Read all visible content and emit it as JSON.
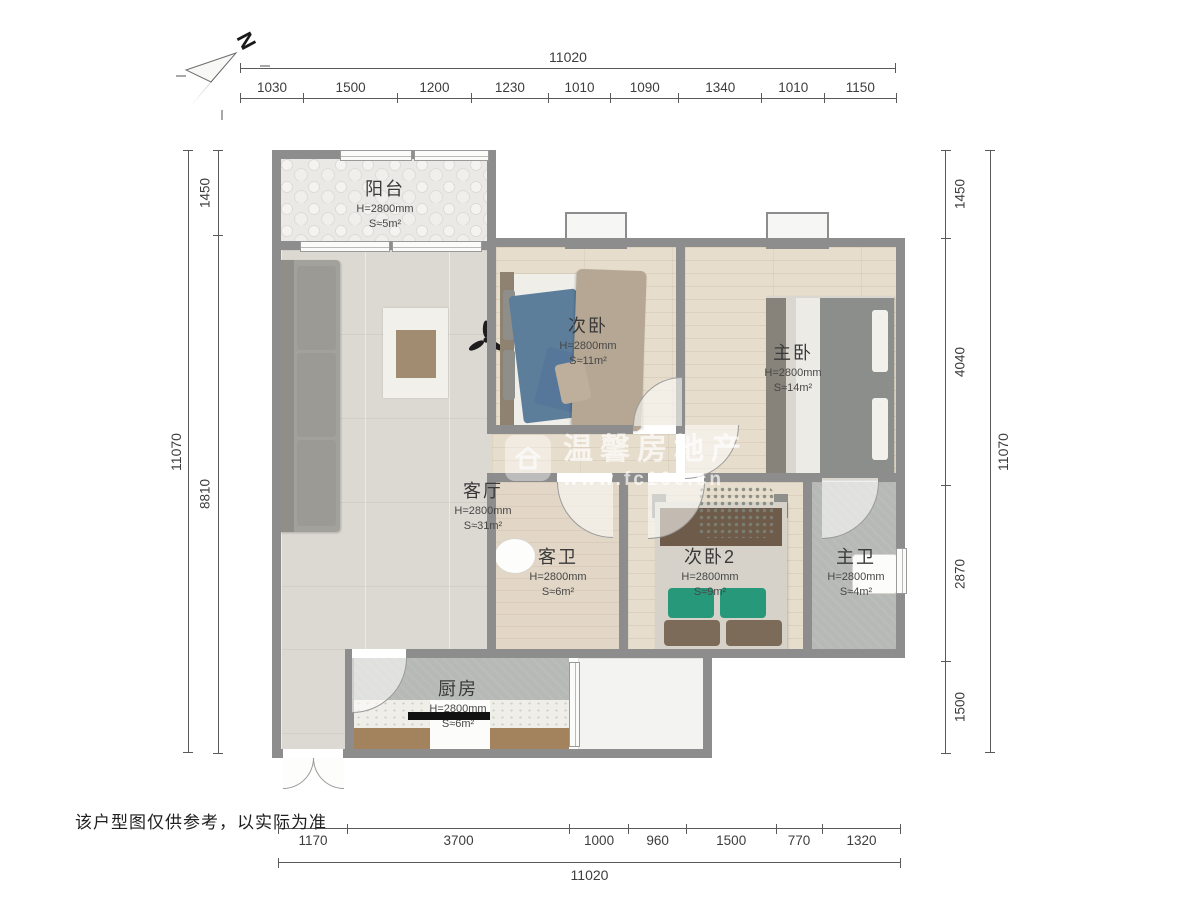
{
  "meta": {
    "disclaimer": "该户型图仅供参考，以实际为准"
  },
  "compass": {
    "label": "N"
  },
  "watermark": {
    "brand": "温馨房地产",
    "url": "www.fc100.cn"
  },
  "rooms": [
    {
      "id": "balcony",
      "name": "阳台",
      "height": "H=2800mm",
      "area": "S≈5m²"
    },
    {
      "id": "second-bedroom",
      "name": "次卧",
      "height": "H=2800mm",
      "area": "S≈11m²"
    },
    {
      "id": "master-bedroom",
      "name": "主卧",
      "height": "H=2800mm",
      "area": "S≈14m²"
    },
    {
      "id": "living-room",
      "name": "客厅",
      "height": "H=2800mm",
      "area": "S≈31m²"
    },
    {
      "id": "guest-bathroom",
      "name": "客卫",
      "height": "H=2800mm",
      "area": "S≈6m²"
    },
    {
      "id": "second-bedroom-2",
      "name": "次卧2",
      "height": "H=2800mm",
      "area": "S≈9m²"
    },
    {
      "id": "master-bathroom",
      "name": "主卫",
      "height": "H=2800mm",
      "area": "S≈4m²"
    },
    {
      "id": "kitchen",
      "name": "厨房",
      "height": "H=2800mm",
      "area": "S≈6m²"
    }
  ],
  "dimensions": {
    "top": {
      "total": "11020",
      "segments": [
        "1030",
        "1500",
        "1200",
        "1230",
        "1010",
        "1090",
        "1340",
        "1010",
        "1150"
      ]
    },
    "bottom": {
      "total": "11020",
      "segments": [
        "1170",
        "3700",
        "1000",
        "960",
        "1500",
        "770",
        "1320"
      ]
    },
    "left": {
      "total": "11070",
      "segments": [
        "1450",
        "8810"
      ]
    },
    "right": {
      "total": "11070",
      "segments": [
        "1450",
        "4040",
        "2870",
        "1500"
      ]
    }
  },
  "colors": {
    "wall": "#8d8d8d",
    "wood_floor": "#e7ddcd",
    "tile_floor": "#dcd9d3",
    "gray_tile": "#b7b9b7",
    "bed_blue": "#5d7e9b",
    "pillow_green": "#27997a",
    "counter_brown": "#a3835e"
  }
}
